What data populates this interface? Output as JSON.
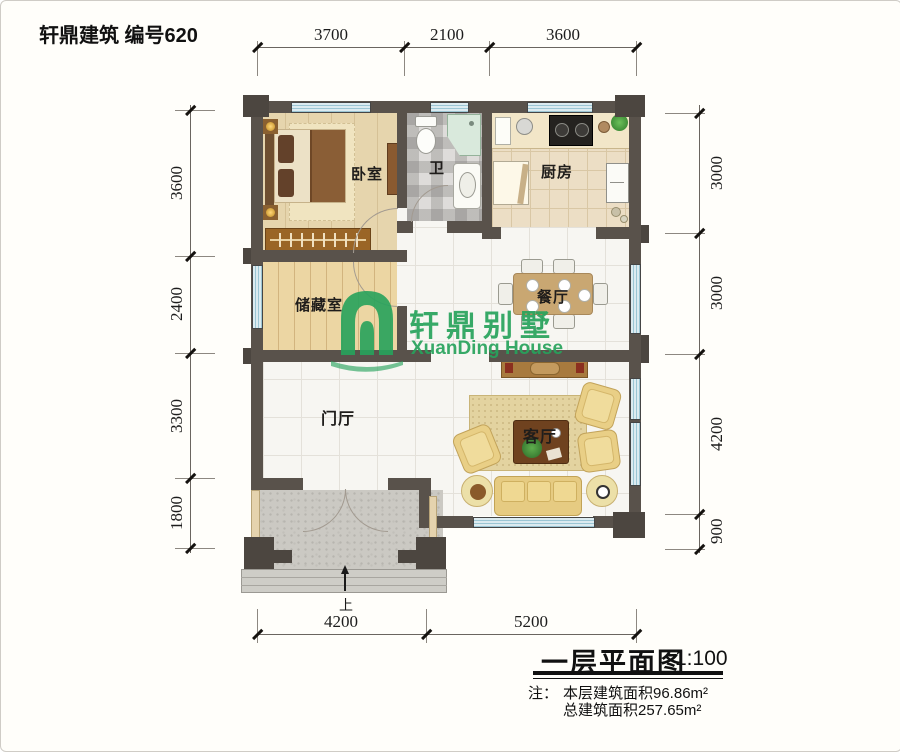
{
  "header": {
    "title": "轩鼎建筑 编号620"
  },
  "logo": {
    "cn": "轩鼎别墅",
    "en": "XuanDing House",
    "color": "#27a35c"
  },
  "rooms": {
    "bedroom": "卧室",
    "bath": "卫",
    "kitchen": "厨房",
    "storage": "储藏室",
    "dining": "餐厅",
    "hall": "门厅",
    "living": "客厅"
  },
  "dims": {
    "top": [
      "3700",
      "2100",
      "3600"
    ],
    "left": [
      "3600",
      "2400",
      "3300",
      "1800"
    ],
    "right": [
      "3000",
      "3000",
      "4200",
      "900"
    ],
    "bottom": [
      "4200",
      "5200"
    ]
  },
  "entrance": {
    "up_label": "上"
  },
  "footer": {
    "plan_title": "一层平面图",
    "scale": "1:100",
    "note_prefix": "注：",
    "note_area_floor": "本层建筑面积96.86m²",
    "note_area_total": "总建筑面积257.65m²"
  },
  "colors": {
    "wall": "#59524b",
    "window_blue": "#9cc6d4",
    "logo_green": "#27a35c"
  }
}
